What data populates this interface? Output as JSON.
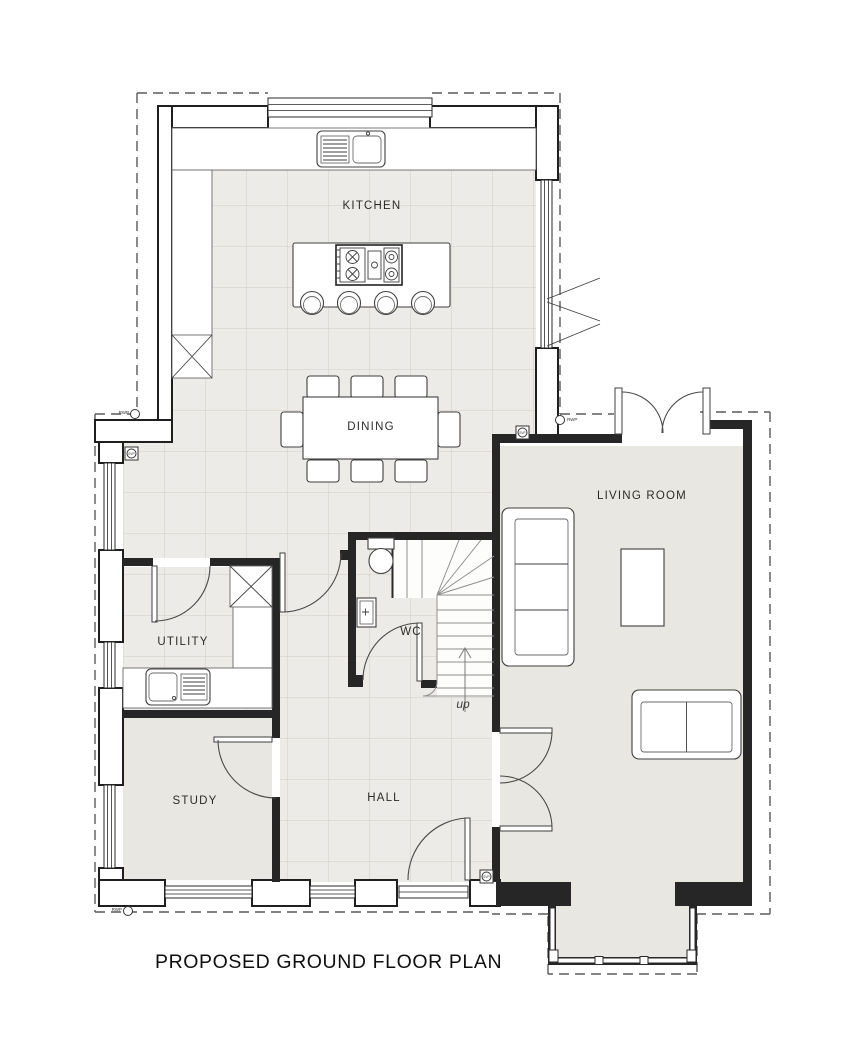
{
  "drawing": {
    "title": "PROPOSED GROUND FLOOR PLAN"
  },
  "rooms": {
    "kitchen": "KITCHEN",
    "dining": "DINING",
    "living_room": "LIVING ROOM",
    "utility": "UTILITY",
    "wc": "WC",
    "study": "STUDY",
    "hall": "HALL"
  },
  "annotations": {
    "stairs_direction": "up",
    "rainwater_pipe": "RWP",
    "soil_vent_pipe": "SVP"
  },
  "colors": {
    "wall_line": "#1f1f1f",
    "partition": "#262626",
    "tile_floor": "#edebe7",
    "plain_floor": "#e9e7e1",
    "detail_line": "#444444",
    "background": "#ffffff"
  }
}
